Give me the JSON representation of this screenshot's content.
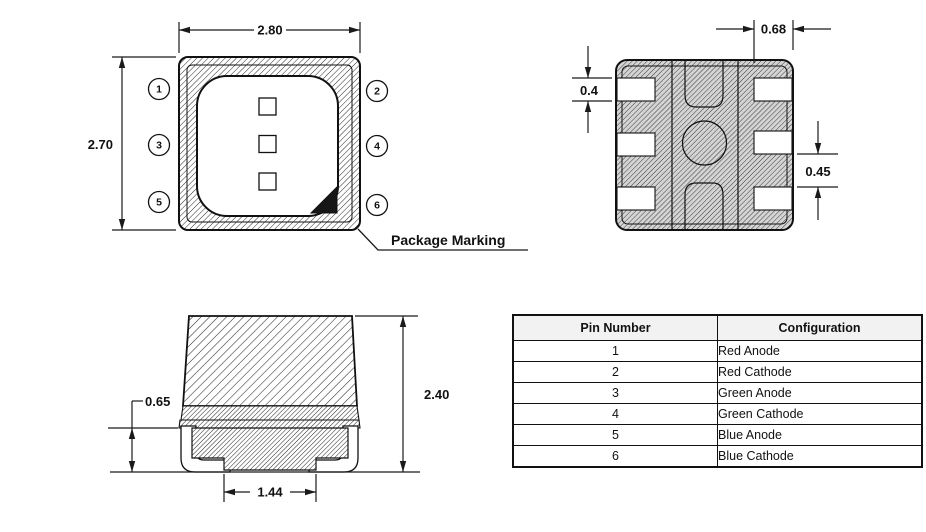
{
  "drawing": {
    "top_view": {
      "width_dim": "2.80",
      "height_dim": "2.70",
      "package_marking_label": "Package Marking",
      "pins": [
        "1",
        "2",
        "3",
        "4",
        "5",
        "6"
      ]
    },
    "pad_view": {
      "pad_length_dim": "0.68",
      "pad_height_dim": "0.4",
      "pad_gap_dim": "0.45"
    },
    "side_view": {
      "standoff_dim": "0.65",
      "total_height_dim": "2.40",
      "lead_span_dim": "1.44"
    }
  },
  "pin_table": {
    "headers": [
      "Pin Number",
      "Configuration"
    ],
    "rows": [
      [
        "1",
        "Red Anode"
      ],
      [
        "2",
        "Red Cathode"
      ],
      [
        "3",
        "Green Anode"
      ],
      [
        "4",
        "Green Cathode"
      ],
      [
        "5",
        "Blue Anode"
      ],
      [
        "6",
        "Blue Cathode"
      ]
    ]
  },
  "colors": {
    "line": "#1a1a1a",
    "table_header_bg": "#f2f2f2"
  }
}
